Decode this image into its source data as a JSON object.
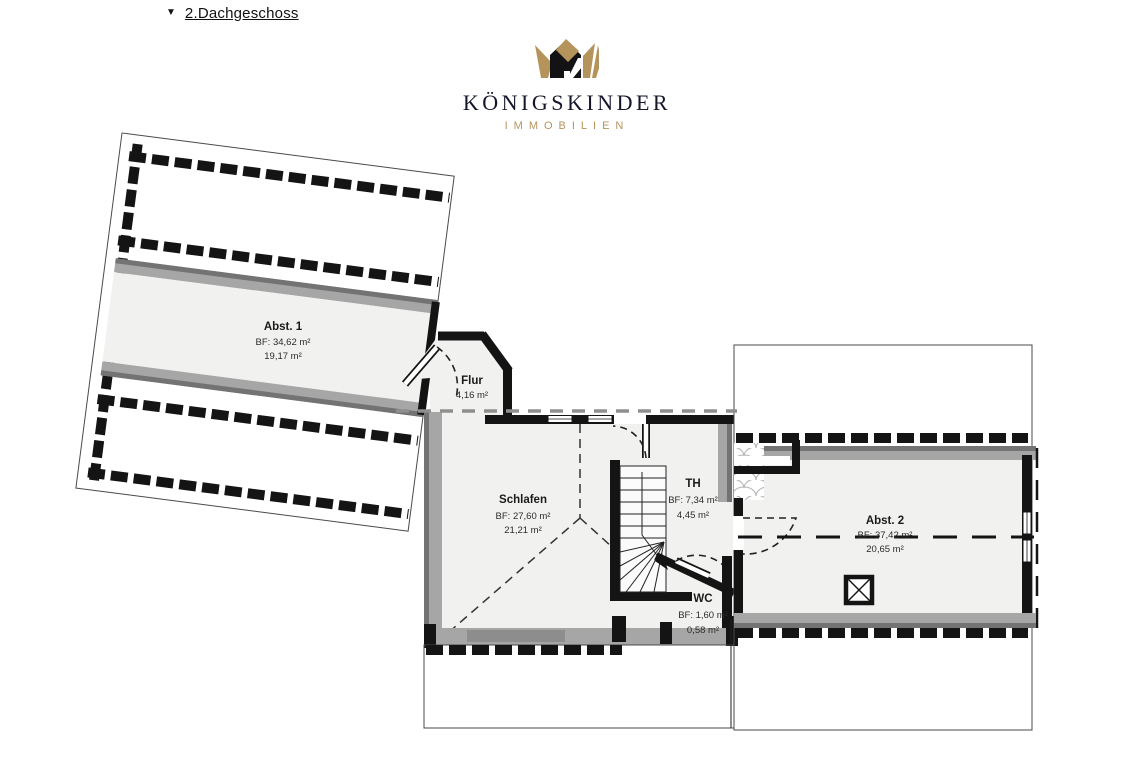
{
  "header": {
    "collapse_icon": "▼",
    "label": "2.Dachgeschoss"
  },
  "logo": {
    "title": "KÖNIGSKINDER",
    "subtitle": "IMMOBILIEN",
    "gold": "#b5945c",
    "dark": "#16162a"
  },
  "rooms": {
    "abst1": {
      "name": "Abst. 1",
      "bf": "BF: 34,62 m²",
      "area": "19,17 m²"
    },
    "flur": {
      "name": "Flur",
      "area": "4,16 m²"
    },
    "schlafen": {
      "name": "Schlafen",
      "bf": "BF: 27,60 m²",
      "area": "21,21 m²"
    },
    "th": {
      "name": "TH",
      "bf": "BF: 7,34 m²",
      "area": "4,45 m²"
    },
    "wc": {
      "name": "WC",
      "bf": "BF: 1,60 m²",
      "area": "0,58 m²"
    },
    "abst2": {
      "name": "Abst. 2",
      "bf": "BF: 37,42 m²",
      "area": "20,65 m²"
    }
  },
  "colors": {
    "wall": "#141414",
    "room_fill": "#f1f1ef",
    "gray_band": "#a6a6a6",
    "gray_dark": "#737373",
    "hatch_line": "#b4b4b4",
    "dash_gray": "#8f8f8f"
  }
}
